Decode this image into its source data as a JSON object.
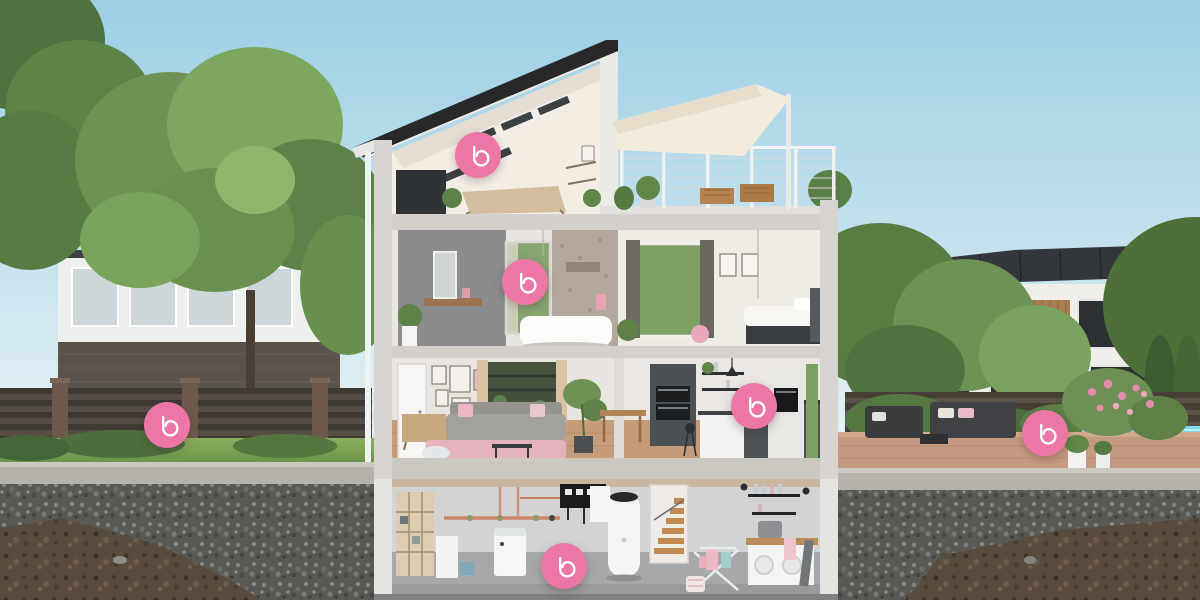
{
  "scene": {
    "type": "interactive-house-cutaway",
    "description": "Photorealistic cross-section render of a three-storey house with basement utility room, attic studio, bathroom and bedroom floor, living room and kitchen, left garden, roof terrace with shade sail, and pool terrace; pink circular brand hotspots are overlaid on each area"
  },
  "brand": {
    "logo_glyph": "b",
    "marker_color": "#ec77a7",
    "logo_color": "#ffffff"
  },
  "hotspots": [
    {
      "name": "attic-studio",
      "glyph": "b",
      "x": 478,
      "y": 155
    },
    {
      "name": "bathroom-floor",
      "glyph": "b",
      "x": 525,
      "y": 282
    },
    {
      "name": "kitchen",
      "glyph": "b",
      "x": 754,
      "y": 406
    },
    {
      "name": "garden",
      "glyph": "b",
      "x": 167,
      "y": 425
    },
    {
      "name": "terrace-pool",
      "glyph": "b",
      "x": 1045,
      "y": 433
    },
    {
      "name": "basement-utility",
      "glyph": "b",
      "x": 564,
      "y": 566
    }
  ],
  "palette": {
    "sky_top": "#9ccfe4",
    "sky_horizon": "#ecf4f5",
    "foliage": "#6f9254",
    "lawn": "#7ba24f",
    "fence_wood": "#3f3933",
    "concrete_cut": "#d5d2cd",
    "gravel": "#585855",
    "soil": "#5a4c3d",
    "pool_water": "#3cc3d5",
    "roof_dark": "#28282a",
    "interior_cream": "#f2ebe2",
    "accent_pink": "#e7b6bf"
  }
}
